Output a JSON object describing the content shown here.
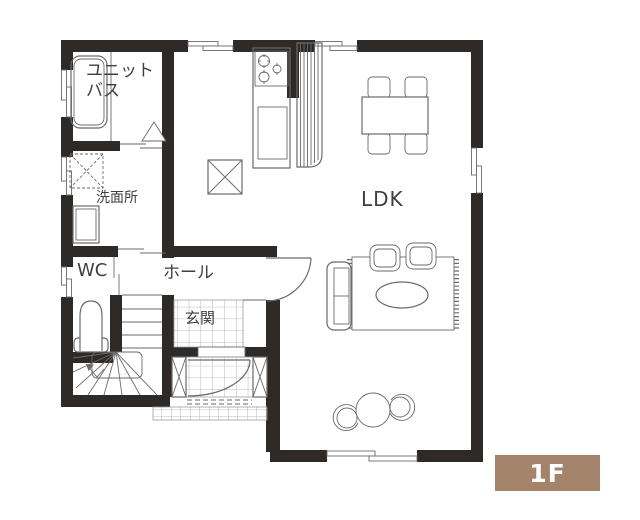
{
  "plan": {
    "floor_badge": "1F",
    "rooms": {
      "unit_bath_line1": "ユニット",
      "unit_bath_line2": "バス",
      "washroom": "洗面所",
      "wc": "WC",
      "hall": "ホール",
      "entrance": "玄関",
      "ldk": "LDK"
    },
    "colors": {
      "wall": "#2d2a28",
      "line": "#6a6a6a",
      "tile_line": "#9d9d9d",
      "text": "#3f3f3f",
      "badge_bg": "#a3846a",
      "badge_text": "#ffffff"
    }
  }
}
